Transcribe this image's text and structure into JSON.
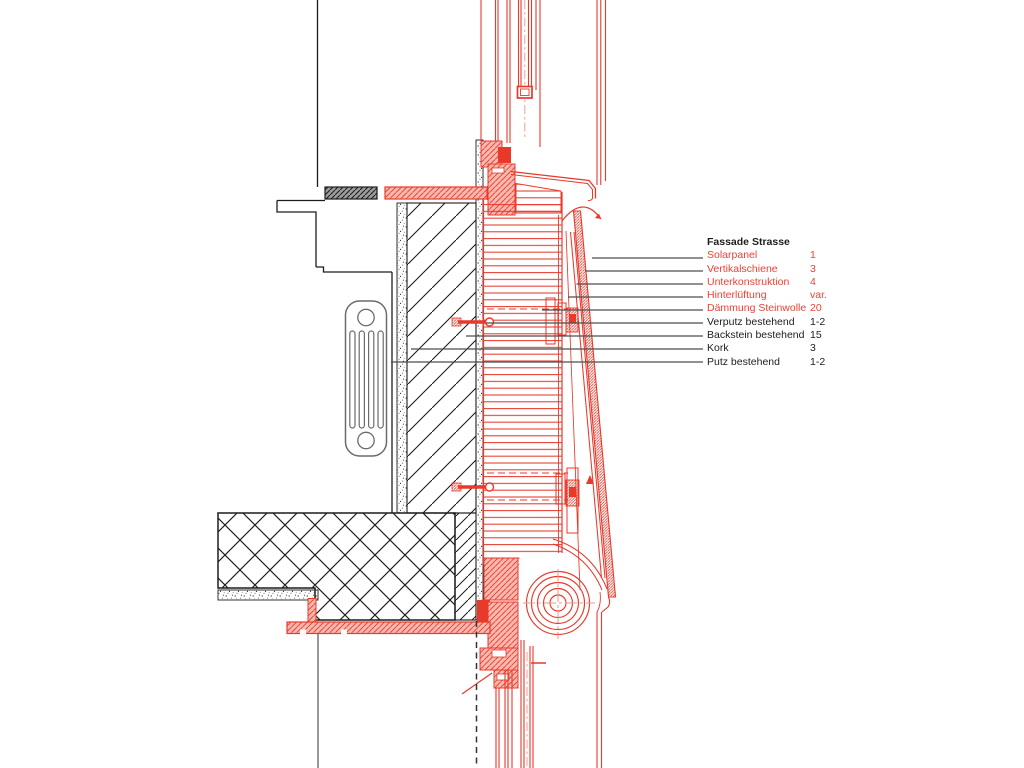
{
  "drawing": {
    "kind": "architectural facade section detail",
    "description": "Vertical section through existing wall with new solar-panel facade system, window above, window below with roller blind",
    "components": [
      "upper-window-glazing",
      "window-frame-head",
      "lintel",
      "radiator",
      "existing-brick-wall",
      "rockwool-insulation",
      "solar-panel",
      "vertical-rail",
      "substructure-brackets",
      "anchor-bolts",
      "concrete-floor-slab",
      "roller-blind-drum",
      "lower-window",
      "window-sill-plate"
    ]
  },
  "legend": {
    "title": "Fassade Strasse",
    "items": [
      {
        "label": "Solarpanel",
        "value": "1",
        "highlight": true
      },
      {
        "label": "Vertikalschiene",
        "value": "3",
        "highlight": true
      },
      {
        "label": "Unterkonstruktion",
        "value": "4",
        "highlight": true
      },
      {
        "label": "Hinterlüftung",
        "value": "var.",
        "highlight": true
      },
      {
        "label": "Dämmung Steinwolle",
        "value": "20",
        "highlight": true
      },
      {
        "label": "Verputz bestehend",
        "value": "1-2",
        "highlight": false
      },
      {
        "label": "Backstein bestehend",
        "value": "15",
        "highlight": false
      },
      {
        "label": "Kork",
        "value": "3",
        "highlight": false
      },
      {
        "label": "Putz bestehend",
        "value": "1-2",
        "highlight": false
      }
    ]
  },
  "colors": {
    "new_construction_red": "#e8392b",
    "legend_red_text": "#ef4136",
    "hatch_fill_pink": "#f9b8ae",
    "existing_black": "#1d1d1b",
    "leader_line_gray": "#4d4d4d"
  }
}
